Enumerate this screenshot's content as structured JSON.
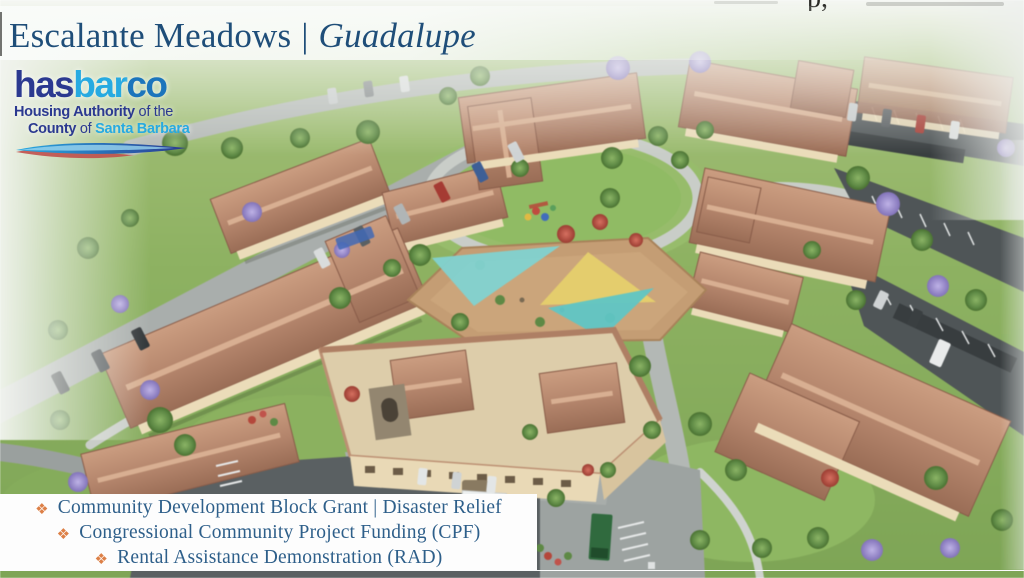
{
  "slide": {
    "title": {
      "project": "Escalante Meadows",
      "separator": "|",
      "location": "Guadalupe",
      "color": "#1f4e79"
    },
    "top_right_cropped_fragment": "p,"
  },
  "logo": {
    "brand_parts": [
      {
        "text": "has",
        "color": "#2b3990"
      },
      {
        "text": "bar",
        "color": "#27aae1"
      },
      {
        "text": "co",
        "color": "#1c75bc"
      }
    ],
    "tagline_line1": {
      "bold": "Housing Authority",
      "rest": " of the"
    },
    "tagline_line2": {
      "bold": "County",
      "mid": " of ",
      "accent": "Santa Barbara"
    },
    "tagline_color": "#2b3990",
    "accent_color": "#27aae1",
    "swoosh_colors": [
      "#27aae1",
      "#2b3990",
      "#c0504d"
    ]
  },
  "funding": {
    "bullet_glyph": "❖",
    "bullet_color": "#dd8047",
    "text_color": "#2e5f8a",
    "items": [
      "Community Development Block Grant | Disaster Relief",
      "Congressional Community Project Funding (CPF)",
      "Rental Assistance Demonstration (RAD)"
    ]
  },
  "rendering": {
    "subject": "aerial-rendering-of-escalante-meadows-housing-development",
    "palette": {
      "grass": "#7da653",
      "roof_tile": "#b5846a",
      "flat_roof": "#decda9",
      "asphalt": "#4f5557",
      "shade_sail_teal": "#6fcdcb",
      "shade_sail_yellow": "#e6cf68",
      "jacaranda": "#8273bb"
    }
  }
}
